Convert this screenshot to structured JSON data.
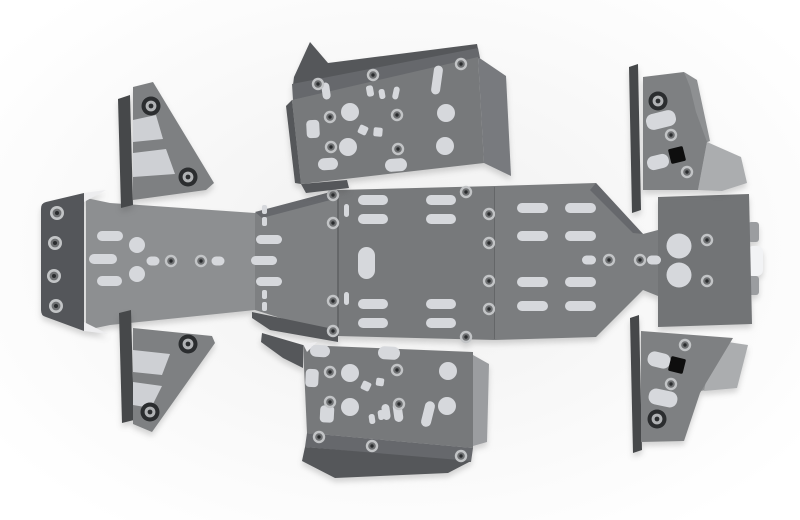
{
  "image": {
    "subject": "Exploded flat-lay product render of a grey aluminium ATV underbody skid plate armour kit with riveted plates and slot cutouts",
    "background_note": "soft light-grey studio backdrop fading to white at edges"
  },
  "palette": {
    "background_center": "#f0f0f0",
    "background_edge": "#ffffff",
    "plate": "#77797b",
    "plate_light": "#8d8f91",
    "plate_mid": "#7e8082",
    "plate_right": "#7b7d7f",
    "plate_rear": "#727476",
    "bevel": "#66686c",
    "bevel_dark": "#55575a",
    "strip": "#46484a",
    "cap": "#54565a",
    "side_wall": "#787a7e",
    "tab": "#9b9da0",
    "flange_light": "#abadaf",
    "fold_mid": "#8e9092",
    "cutout": "#d6d8dc",
    "cutout_dim": "#ced0d4",
    "white_tab": "#f2f3f5",
    "highlight": "#ededef",
    "black_cutout": "#0e0e0e",
    "rivet_ring": "#c2c4c6",
    "rivet_mid": "#6e7072",
    "rivet_core": "#2a2c2e",
    "bigrivet_ring": "#2b2d2f",
    "bigrivet_mid": "#b0b2b4",
    "seam": "#5f6163"
  },
  "parts": [
    {
      "id": "front-bumper-cap",
      "position": "far left"
    },
    {
      "id": "front-skid-plate",
      "position": "left of center strip"
    },
    {
      "id": "center-skid-plate",
      "position": "middle of center strip"
    },
    {
      "id": "rear-skid-plate",
      "position": "far right of center strip"
    },
    {
      "id": "side-plate-top",
      "position": "top center"
    },
    {
      "id": "side-plate-bottom",
      "position": "bottom center"
    },
    {
      "id": "a-arm-guard-top-left",
      "position": "upper left triangle"
    },
    {
      "id": "a-arm-guard-bottom-left",
      "position": "lower left triangle"
    },
    {
      "id": "footwell-guard-top-right",
      "position": "upper right bracket"
    },
    {
      "id": "footwell-guard-bottom-right",
      "position": "lower right bracket"
    }
  ]
}
